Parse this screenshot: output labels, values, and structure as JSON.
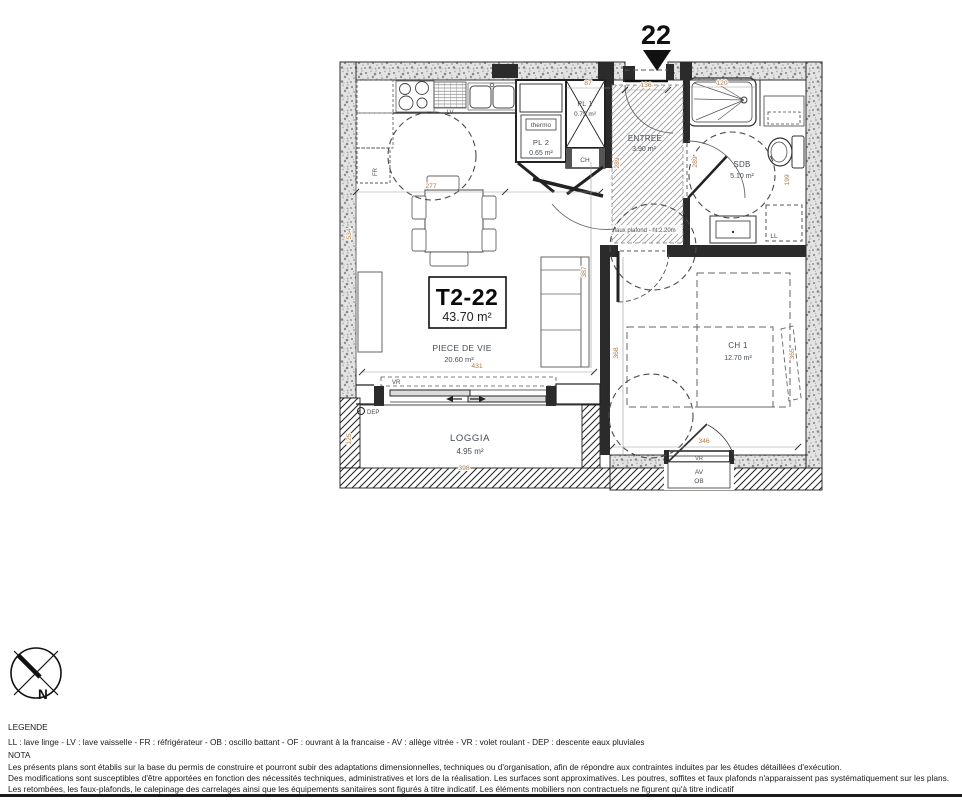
{
  "unit": {
    "number": "22",
    "code": "T2-22",
    "total_area": "43.70 m²"
  },
  "rooms": {
    "living": {
      "name": "PIECE DE VIE",
      "area": "20.60 m²"
    },
    "entree": {
      "name": "ENTREE",
      "area": "3.90 m²"
    },
    "sdb": {
      "name": "SDB",
      "area": "5.10 m²"
    },
    "bedroom": {
      "name": "CH 1",
      "area": "12.70 m²"
    },
    "loggia": {
      "name": "LOGGIA",
      "area": "4.95 m²"
    },
    "closet1": {
      "name": "PL 1",
      "area": "0.75 m²"
    },
    "closet2": {
      "name": "PL 2",
      "area": "0.65 m²"
    }
  },
  "annotations": {
    "thermo": "thermo",
    "water_heater": "CH",
    "dishwasher": "LV",
    "fridge": "FR",
    "washing_machine": "LL",
    "shutter": "VR",
    "glazed_sill": "AV",
    "tilt_window": "OB",
    "rain_pipe": "DEP",
    "false_ceiling": "faux plafond - ht:2.20m",
    "north": "N"
  },
  "dimensions": {
    "pl1_width": "87",
    "entry_door": "136",
    "shower": "120",
    "entree_depth": "289",
    "sdb_depth": "289",
    "sdb_side": "199",
    "kitchen_width": "277",
    "living_depth": "534",
    "living_width": "431",
    "living_side": "387",
    "bedroom_depth": "368",
    "bedroom_width": "365",
    "bedroom_window": "346",
    "loggia_depth": "125",
    "loggia_width": "398"
  },
  "legend": {
    "title": "LEGENDE",
    "abbreviations": "LL : lave linge  - LV : lave vaisselle - FR : réfrigérateur - OB : oscillo battant - OF : ouvrant à la francaise - AV : allège vitrée - VR : volet roulant -  DEP : descente eaux pluviales",
    "nota_title": "NOTA",
    "nota_lines": [
      "Les présents plans sont établis sur la base du permis de construire et pourront subir des adaptations dimensionnelles, techniques ou d'organisation, afin de répondre aux contraintes induites par les études détaillées d'exécution.",
      "Des modifications sont susceptibles d'être apportées en fonction des nécessités techniques, administratives et lors de la réalisation. Les surfaces sont approximatives. Les poutres, soffites et faux plafonds n'apparaissent pas systématiquement sur les plans.",
      "Les retombées, les faux-plafonds, le calepinage des carrelages ainsi que les équipements sanitaires sont figurés à titre indicatif. Les éléments mobiliers non contractuels ne figurent qu'à titre indicatif"
    ]
  },
  "colors": {
    "dimension_text": "#b07a45",
    "room_label": "#454d54",
    "wall_line": "#1a1a1a"
  }
}
